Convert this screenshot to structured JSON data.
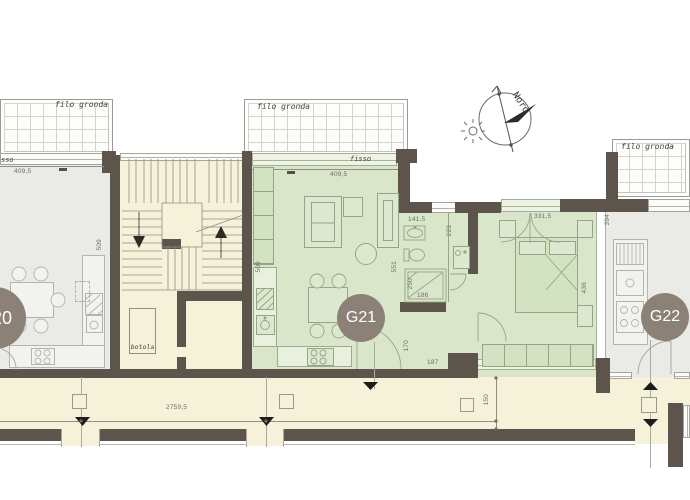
{
  "colors": {
    "wall": "#5d554c",
    "floor_green": "#d9e6ca",
    "floor_cream": "#f6f1d9",
    "floor_gray": "#eaeae7",
    "unit_badge": "#8b8177"
  },
  "compass": {
    "north_label": "Nord"
  },
  "eaves": {
    "left": "filo gronda",
    "center": "filo gronda",
    "right": "filo gronda"
  },
  "units": {
    "g20": "G20",
    "g21": "G21",
    "g22": "G22"
  },
  "window_labels": {
    "g20_fixed_partial": "sso",
    "g21_fixed": "fisso"
  },
  "stair": {
    "hatch": "botola"
  },
  "dims": {
    "g20_width": "409,5",
    "g20_depth": "509",
    "g21_width": "409,5",
    "g21_depth_left": "509",
    "g21_depth_right": "551",
    "bath_width": "141,5",
    "bath_shaft": "223",
    "shower_depth": "250",
    "shower_width": "186",
    "hall_depth": "170",
    "hall_width": "187",
    "bedroom_window": "331,5",
    "bedroom_depth": "436",
    "g22_kitchen": "394",
    "balcony_length": "2759,5",
    "balcony_depth": "150"
  }
}
